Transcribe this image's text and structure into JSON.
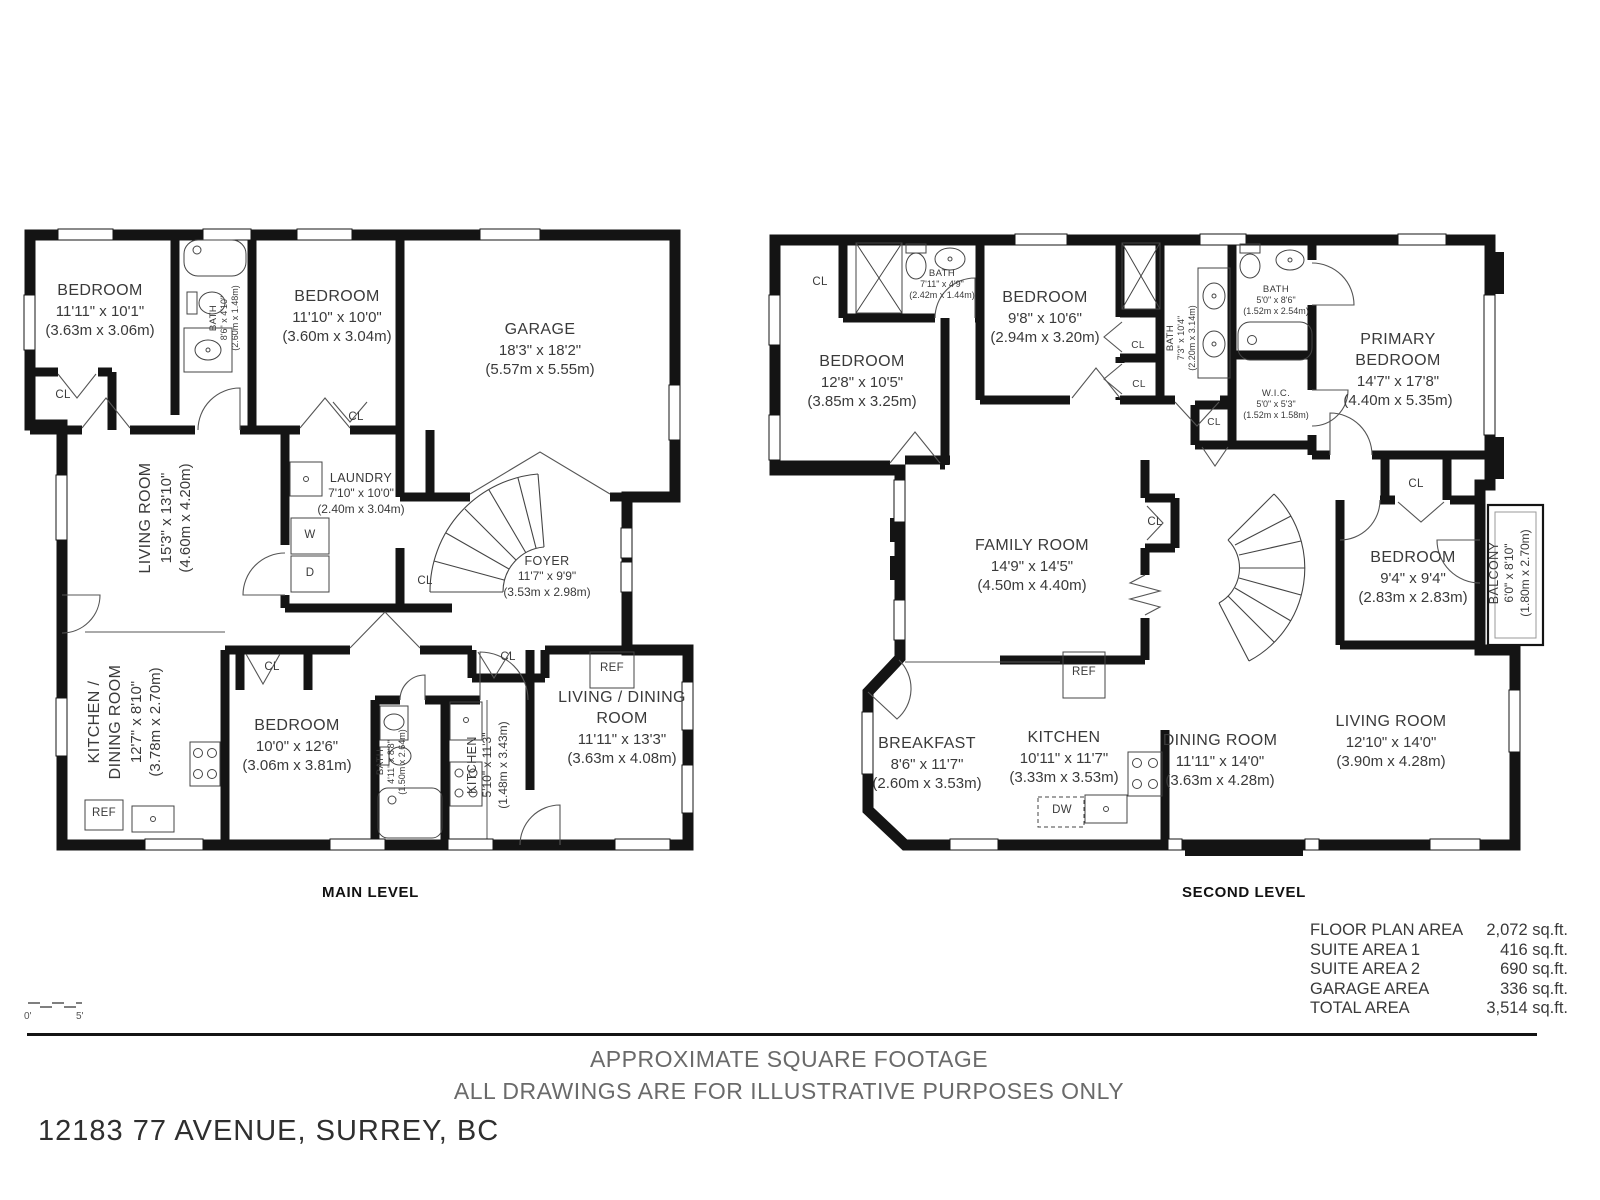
{
  "title_block": {
    "disclaimer_line1": "APPROXIMATE SQUARE FOOTAGE",
    "disclaimer_line2": "ALL DRAWINGS ARE FOR ILLUSTRATIVE PURPOSES ONLY",
    "address": "12183 77 AVENUE, SURREY, BC"
  },
  "scale_bar": {
    "start": "0'",
    "end": "5'"
  },
  "fixtures": {
    "cl": "CL",
    "w": "W",
    "d": "D",
    "ref": "REF",
    "dw": "DW"
  },
  "colors": {
    "wall": "#141414",
    "text": "#3a3a3a",
    "muted": "#6a6a6a"
  },
  "areas": {
    "rows": [
      {
        "label": "FLOOR PLAN AREA",
        "value": "2,072 sq.ft."
      },
      {
        "label": "SUITE AREA 1",
        "value": "416 sq.ft."
      },
      {
        "label": "SUITE AREA 2",
        "value": "690 sq.ft."
      },
      {
        "label": "GARAGE AREA",
        "value": "336 sq.ft."
      },
      {
        "label": "TOTAL AREA",
        "value": "3,514 sq.ft."
      }
    ]
  },
  "levels": {
    "main": {
      "label": "MAIN LEVEL",
      "rooms": {
        "bedroom1": {
          "name": "BEDROOM",
          "imperial": "11'11\" x 10'1\"",
          "metric": "(3.63m x 3.06m)"
        },
        "bath1": {
          "name": "BATH",
          "imperial": "8'6\" x 4'10\"",
          "metric": "(2.60m x 1.48m)"
        },
        "bedroom2": {
          "name": "BEDROOM",
          "imperial": "11'10\" x 10'0\"",
          "metric": "(3.60m x 3.04m)"
        },
        "garage": {
          "name": "GARAGE",
          "imperial": "18'3\" x 18'2\"",
          "metric": "(5.57m x 5.55m)"
        },
        "living": {
          "name": "LIVING ROOM",
          "imperial": "15'3\" x 13'10\"",
          "metric": "(4.60m x 4.20m)"
        },
        "laundry": {
          "name": "LAUNDRY",
          "imperial": "7'10\" x 10'0\"",
          "metric": "(2.40m x 3.04m)"
        },
        "foyer": {
          "name": "FOYER",
          "imperial": "11'7\" x 9'9\"",
          "metric": "(3.53m x 2.98m)"
        },
        "kitchen_dining": {
          "name": "KITCHEN / DINING ROOM",
          "imperial": "12'7\" x 8'10\"",
          "metric": "(3.78m x 2.70m)"
        },
        "bedroom3": {
          "name": "BEDROOM",
          "imperial": "10'0\" x 12'6\"",
          "metric": "(3.06m x 3.81m)"
        },
        "bath2": {
          "name": "BATH",
          "imperial": "4'11\" x 8'8\"",
          "metric": "(1.50m x 2.64m)"
        },
        "kitchen": {
          "name": "KITCHEN",
          "imperial": "5'10\" x 11'3\"",
          "metric": "(1.48m x 3.43m)"
        },
        "living_dining": {
          "name": "LIVING / DINING ROOM",
          "imperial": "11'11\" x 13'3\"",
          "metric": "(3.63m x 4.08m)"
        }
      }
    },
    "second": {
      "label": "SECOND LEVEL",
      "rooms": {
        "bedroom1": {
          "name": "BEDROOM",
          "imperial": "12'8\" x 10'5\"",
          "metric": "(3.85m x 3.25m)"
        },
        "bath1": {
          "name": "BATH",
          "imperial": "7'11\" x 4'9\"",
          "metric": "(2.42m x 1.44m)"
        },
        "bedroom2": {
          "name": "BEDROOM",
          "imperial": "9'8\" x 10'6\"",
          "metric": "(2.94m x 3.20m)"
        },
        "bath2": {
          "name": "BATH",
          "imperial": "7'3\" x 10'4\"",
          "metric": "(2.20m x 3.14m)"
        },
        "bath3": {
          "name": "BATH",
          "imperial": "5'0\" x 8'6\"",
          "metric": "(1.52m x 2.54m)"
        },
        "wic": {
          "name": "W.I.C.",
          "imperial": "5'0\" x 5'3\"",
          "metric": "(1.52m x 1.58m)"
        },
        "primary": {
          "name": "PRIMARY BEDROOM",
          "imperial": "14'7\" x 17'8\"",
          "metric": "(4.40m x 5.35m)"
        },
        "family": {
          "name": "FAMILY ROOM",
          "imperial": "14'9\" x 14'5\"",
          "metric": "(4.50m x 4.40m)"
        },
        "bedroom3": {
          "name": "BEDROOM",
          "imperial": "9'4\" x 9'4\"",
          "metric": "(2.83m x 2.83m)"
        },
        "balcony": {
          "name": "BALCONY",
          "imperial": "6'0\" x 8'10\"",
          "metric": "(1.80m x 2.70m)"
        },
        "breakfast": {
          "name": "BREAKFAST",
          "imperial": "8'6\" x 11'7\"",
          "metric": "(2.60m x 3.53m)"
        },
        "kitchen": {
          "name": "KITCHEN",
          "imperial": "10'11\" x 11'7\"",
          "metric": "(3.33m x 3.53m)"
        },
        "dining": {
          "name": "DINING ROOM",
          "imperial": "11'11\" x 14'0\"",
          "metric": "(3.63m x 4.28m)"
        },
        "living": {
          "name": "LIVING ROOM",
          "imperial": "12'10\" x 14'0\"",
          "metric": "(3.90m x 4.28m)"
        }
      }
    }
  }
}
